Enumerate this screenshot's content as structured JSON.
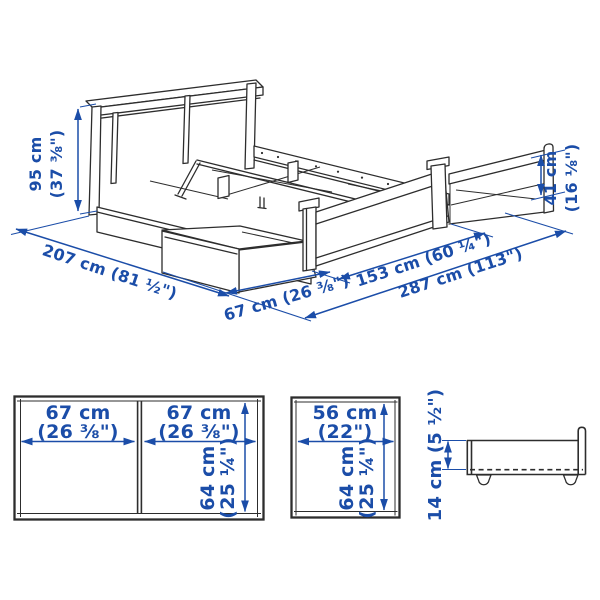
{
  "colors": {
    "dimension_blue": "#1b4da8",
    "drawing_line": "#2d2d2d",
    "background": "#ffffff"
  },
  "bed_view": {
    "headboard_height": {
      "line1": "95 cm",
      "line2": "(37 ⅜\")"
    },
    "bed_length": "207 cm (81 ½\")",
    "box_extension": "67 cm (26 ⅜\")",
    "bed_width": "153 cm (60 ¼\")",
    "total_width_boxes_out": "287 cm (113\")",
    "footboard_height": {
      "line1": "41 cm",
      "line2": "(16 ⅛\")"
    }
  },
  "double_box_front_view": {
    "left_box_width": {
      "line1": "67 cm",
      "line2": "(26 ⅜\")"
    },
    "right_box_width": {
      "line1": "67 cm",
      "line2": "(26 ⅜\")"
    },
    "box_height": {
      "line1": "64 cm",
      "line2": "(25 ¼\")"
    }
  },
  "single_box_front_view": {
    "box_width": {
      "line1": "56 cm",
      "line2": "(22\")"
    },
    "box_height": {
      "line1": "64 cm",
      "line2": "(25 ¼\")"
    }
  },
  "box_side_view": {
    "box_height_with_castors": "14 cm (5 ½\")"
  }
}
